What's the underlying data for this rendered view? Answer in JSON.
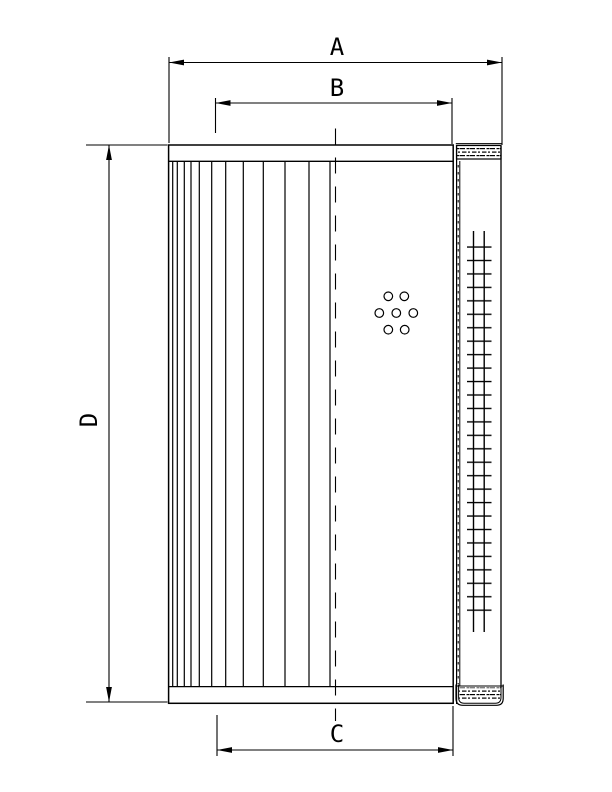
{
  "page": {
    "background_color": "#ffffff",
    "line_color": "#000000"
  },
  "drawing": {
    "description": "dimension drawing of a cylindrical filter element: half-section with pleated media (left), centerline, bolt-hole circle pattern, and outer shell side view with mesh (right)",
    "dimension_labels": {
      "a": "A",
      "b": "B",
      "c": "C",
      "d": "D"
    }
  }
}
